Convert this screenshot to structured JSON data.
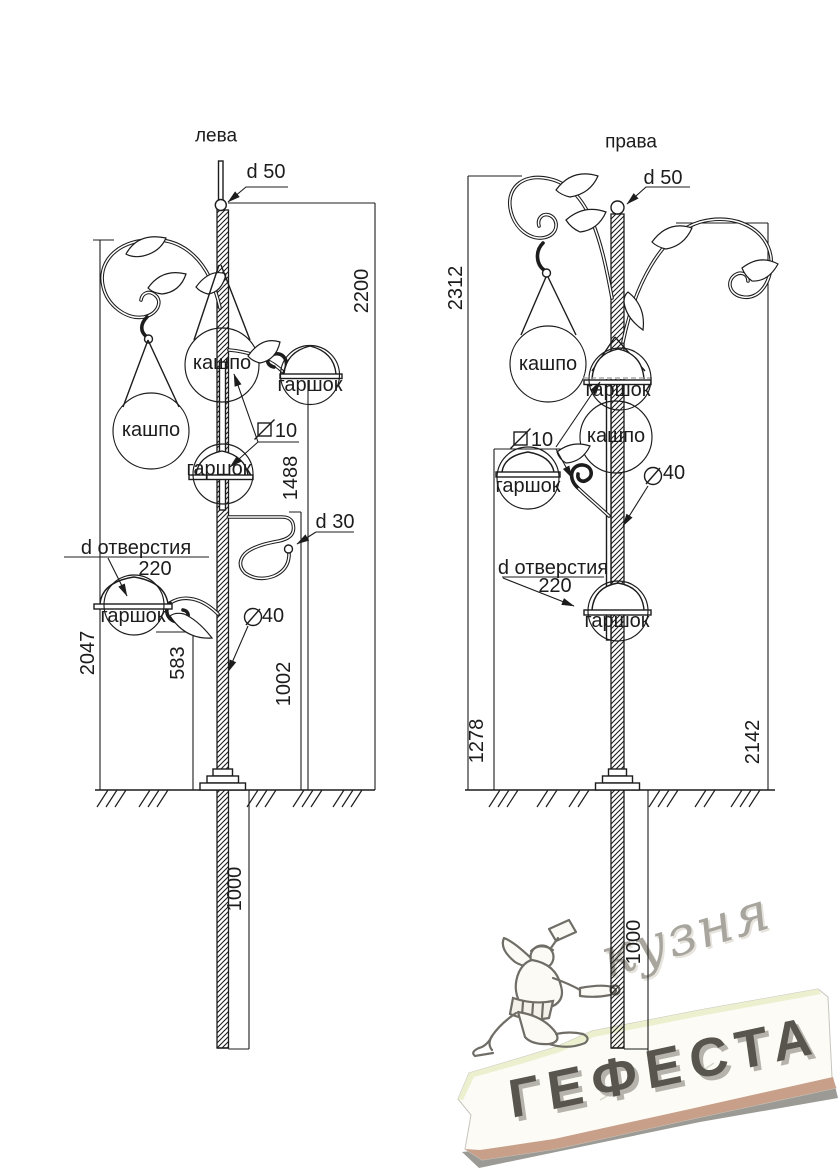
{
  "document_type": "forged pole technical drawing",
  "palette": {
    "line": "#1c1c1c",
    "hidden_line_gray": "#9a9a9a",
    "watermark_script_gray": "#a7a59d",
    "slab_face": "#fcfbf5",
    "slab_highlight": "#edf0cf",
    "slab_edge_tan": "#c89f89",
    "slab_shadow": "#83817a",
    "letters_dark": "#57554d"
  },
  "left_view": {
    "title": "лева",
    "callouts": {
      "top_diameter": "d 50",
      "square_bar": "10",
      "hook_diameter": "d 30",
      "pole_diameter": "40",
      "hole_diameter_label": "d отверстия",
      "hole_diameter_value": "220",
      "planter_top": "кашпо",
      "planter_left": "кашпо",
      "pot_right": "гаршок",
      "pot_middle": "гаршок",
      "pot_bottom": "гаршок"
    },
    "dimensions": {
      "total_height": "2200",
      "scroll_height": "2047",
      "pot_right_height": "1488",
      "hook_height": "1002",
      "pot_bottom_height": "583",
      "underground_depth": "1000"
    }
  },
  "right_view": {
    "title": "права",
    "callouts": {
      "top_diameter": "d 50",
      "square_bar": "10",
      "pole_diameter": "40",
      "hole_diameter_label": "d отверстия",
      "hole_diameter_value": "220",
      "planter_left": "кашпо",
      "planter_center": "кашпо",
      "pot_top": "гаршок",
      "pot_left": "гаршок",
      "pot_bottom": "гаршок"
    },
    "dimensions": {
      "total_height": "2312",
      "right_scroll_height": "2142",
      "pot_left_height": "1278",
      "underground_depth": "1000"
    }
  },
  "watermark": {
    "studio_script": "кузня",
    "studio_name": "ГЕФЕСТА"
  }
}
